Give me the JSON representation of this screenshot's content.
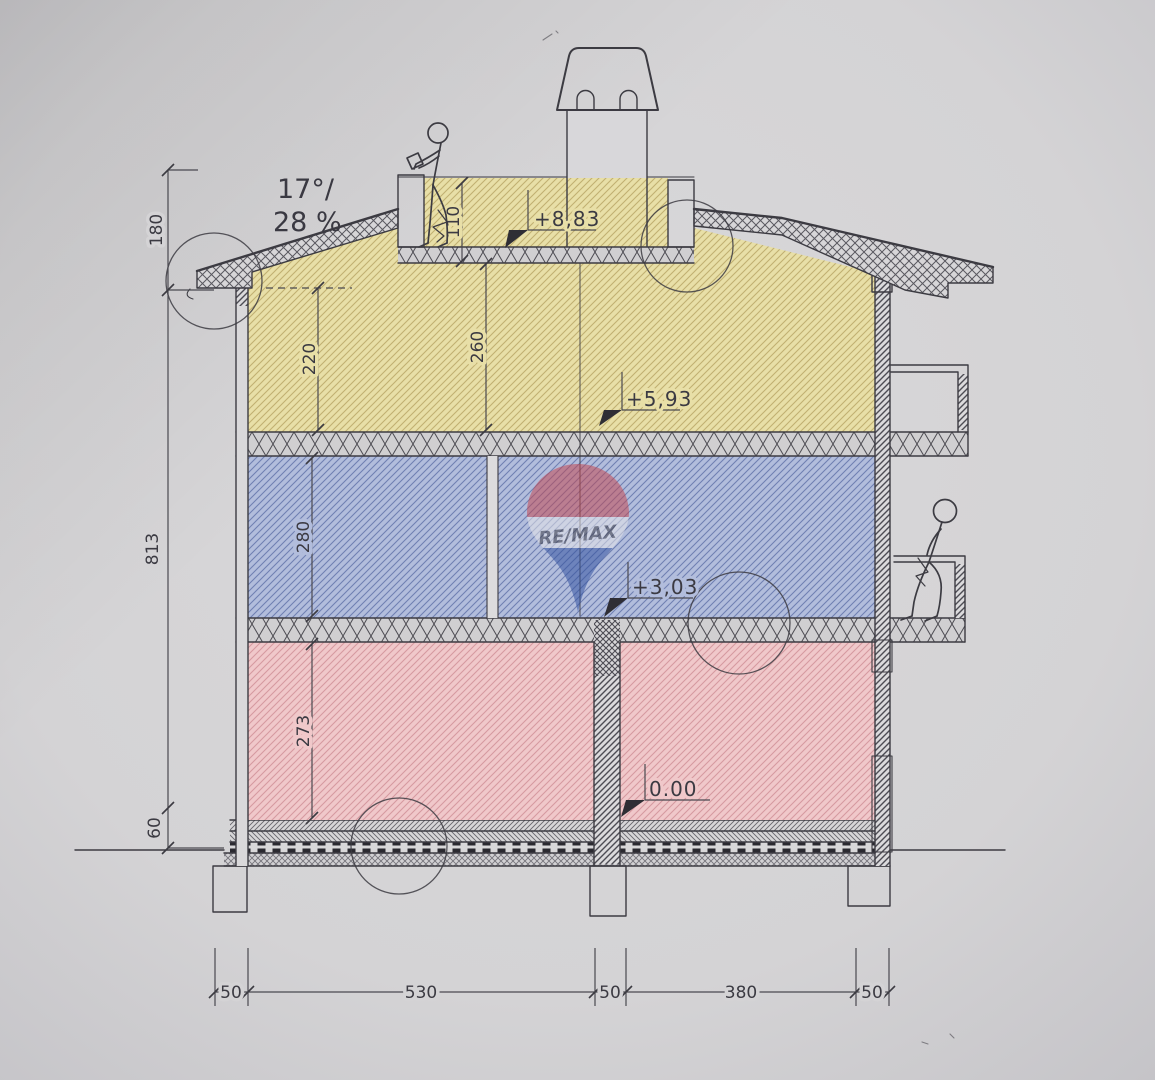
{
  "drawing": {
    "slope_annotation": {
      "line1": "17°/",
      "line2": "28 %"
    },
    "elevation_markers": [
      {
        "label": "+8,83"
      },
      {
        "label": "+5,93"
      },
      {
        "label": "+3,03"
      },
      {
        "label": "0.00"
      }
    ],
    "room_height_dims": [
      {
        "label": "110"
      },
      {
        "label": "220"
      },
      {
        "label": "260"
      },
      {
        "label": "280"
      },
      {
        "label": "273"
      }
    ],
    "left_dims": [
      {
        "label": "180"
      },
      {
        "label": "813"
      },
      {
        "label": "60"
      }
    ],
    "bottom_dims": [
      {
        "label": "50"
      },
      {
        "label": "530"
      },
      {
        "label": "50"
      },
      {
        "label": "380"
      },
      {
        "label": "50"
      }
    ],
    "watermark": {
      "brand": "RE/MAX",
      "red": "#c4454e",
      "blue": "#30509f"
    },
    "colors": {
      "paper": "#d4d3d5",
      "ink": "#3c3b42",
      "attic_fill": "#e8dfa7",
      "upper_floor_fill": "#b2bddc",
      "ground_floor_fill": "#f0c8ca"
    }
  }
}
